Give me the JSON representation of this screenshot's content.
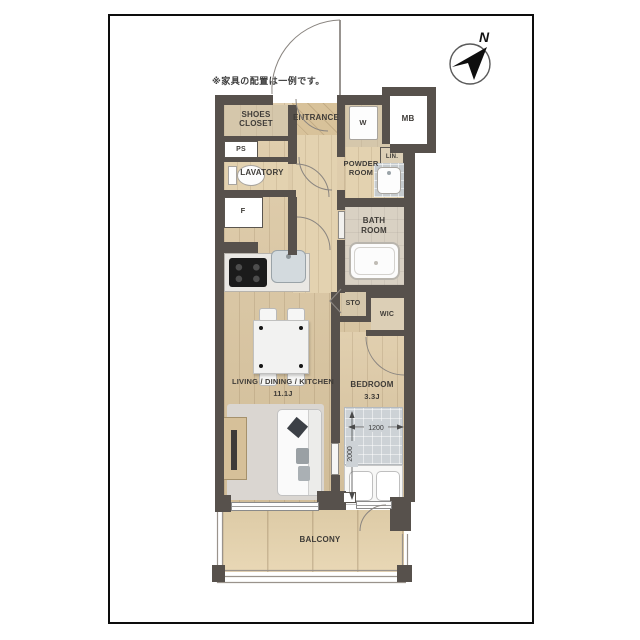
{
  "note": "※家具の配置は一例です。",
  "compass_n": "N",
  "rooms": {
    "shoes": {
      "l1": "SHOES",
      "l2": "CLOSET"
    },
    "entrance": "ENTRANCE",
    "washer": "W",
    "meter_box": "MB",
    "pipe_space": "PS",
    "lavatory": "LAVATORY",
    "powder": {
      "l1": "POWDER",
      "l2": "ROOM"
    },
    "linen": "LIN.",
    "bath": {
      "l1": "BATH",
      "l2": "ROOM"
    },
    "fridge": "F",
    "storage": "STO",
    "wic": "WIC",
    "ldk": {
      "name": "LIVING / DINING / KITCHEN",
      "size": "11.1J"
    },
    "bedroom": {
      "name": "BEDROOM",
      "size": "3.3J"
    },
    "balcony": "BALCONY"
  },
  "dimensions": {
    "bed_width": "1200",
    "bed_length": "2000"
  },
  "colors": {
    "wall": "#57514c",
    "wood_floor": "#dcc7a1",
    "closet_floor": "#d5c7ab",
    "balcony_floor": "#e6d3ad",
    "bath_tile": "#d9d1c3",
    "rug": "#dad6d1",
    "bed_duvet": "#cdd2d6",
    "frame_border": "#0d0d0d"
  }
}
